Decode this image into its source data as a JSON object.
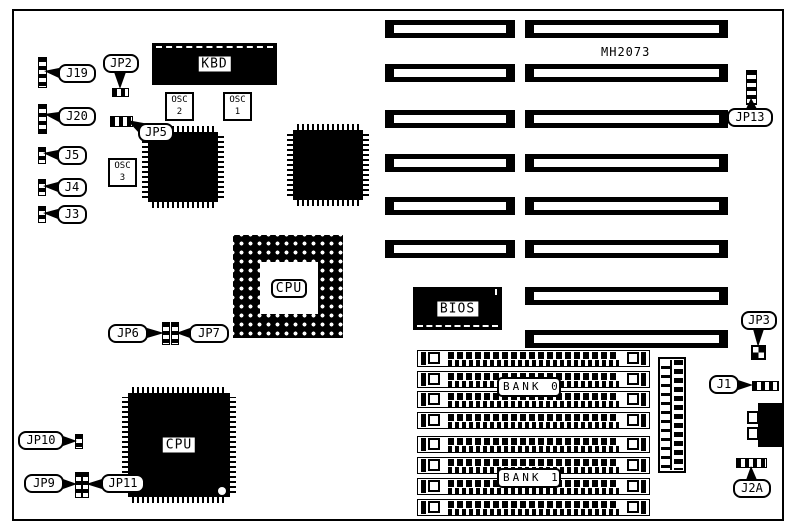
{
  "part_number": "MH2073",
  "labels": {
    "j19": "J19",
    "jp2": "JP2",
    "j20": "J20",
    "jp5": "JP5",
    "j5": "J5",
    "j4": "J4",
    "j3": "J3",
    "jp6": "JP6",
    "jp7": "JP7",
    "jp9": "JP9",
    "jp10": "JP10",
    "jp11": "JP11",
    "jp13": "JP13",
    "jp3": "JP3",
    "j1": "J1",
    "j2a": "J2A"
  },
  "chips": {
    "kbd": "KBD",
    "bios": "BIOS",
    "cpu_socket": "CPU",
    "cpu_chip": "CPU",
    "osc1": {
      "name": "OSC",
      "num": "1"
    },
    "osc2": {
      "name": "OSC",
      "num": "2"
    },
    "osc3": {
      "name": "OSC",
      "num": "3"
    }
  },
  "memory": {
    "bank0": "BANK 0",
    "bank1": "BANK 1"
  }
}
